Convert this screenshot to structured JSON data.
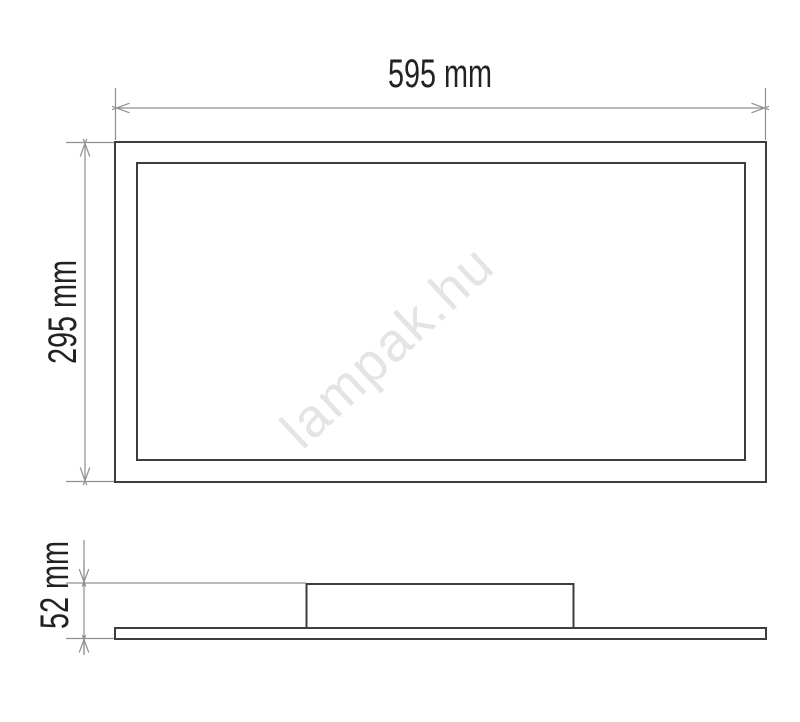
{
  "drawing": {
    "title": "LED panel dimensional drawing",
    "watermark": {
      "text": "lampak.hu",
      "color": "#e4e4e4"
    },
    "colors": {
      "outline": "#3d3d3d",
      "dimension_lines": "#909090",
      "label_text": "#222222",
      "background": "#ffffff"
    },
    "front_view": {
      "width": {
        "label": "595 mm",
        "value": 595,
        "unit": "mm"
      },
      "height": {
        "label": "295 mm",
        "value": 295,
        "unit": "mm"
      }
    },
    "side_view": {
      "height": {
        "label": "52 mm",
        "value": 52,
        "unit": "mm"
      }
    }
  }
}
